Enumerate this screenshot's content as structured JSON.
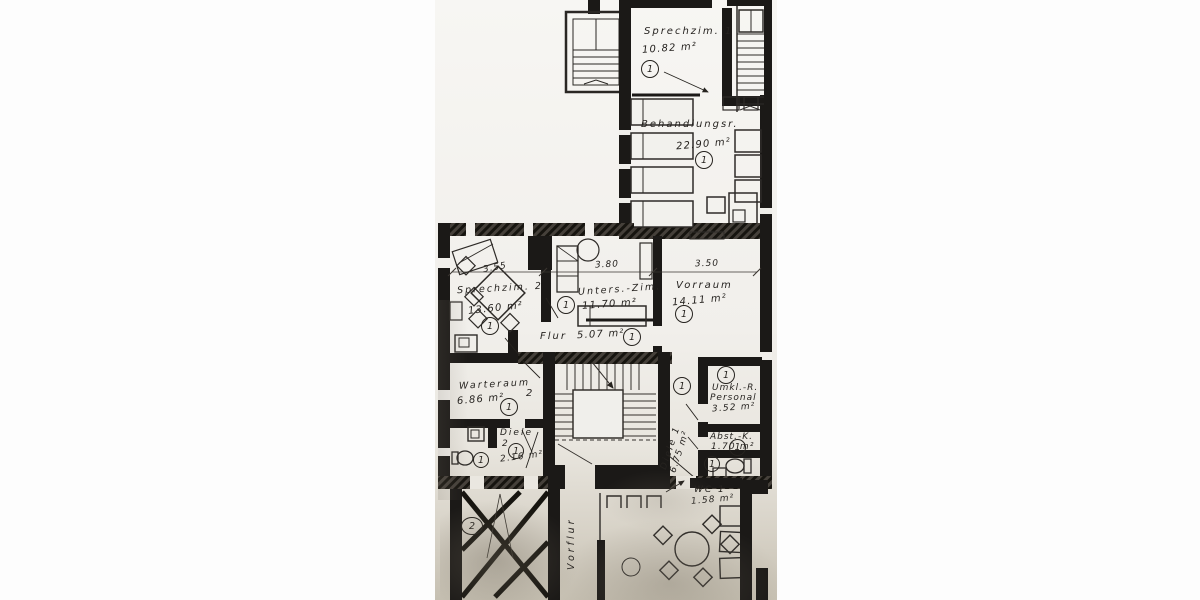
{
  "plan": {
    "rooms": {
      "sprechzim1": {
        "name": "Sprechzim. 1",
        "area": "10.82 m²",
        "mark": "1"
      },
      "behandlungsraum": {
        "name": "Behandlungsr.",
        "area": "22.90 m²",
        "mark": "1"
      },
      "sprechzim2": {
        "name": "Sprechzim. 2",
        "area": "13.60 m²",
        "mark": "1"
      },
      "untersuchungszimmer der": {
        "name": "Unters.-Zim.",
        "area": "11.70 m²",
        "mark": "1"
      },
      "vorraum": {
        "name": "Vorraum",
        "area": "14.11 m²",
        "mark": "1"
      },
      "flur": {
        "name": "Flur",
        "area": "5.07 m²",
        "mark": "1"
      },
      "warteraum": {
        "name": "Warteraum",
        "number": "2",
        "area": "6.86 m²",
        "mark": "1"
      },
      "diele2": {
        "name": "Diele",
        "number": "2",
        "area": "2.16 m²",
        "mark": "1",
        "wc_mark": "1"
      },
      "diele1": {
        "name": "Diele 1",
        "area": "6.75 m²",
        "mark": "1"
      },
      "umkleide_personal": {
        "name": "Umkl.-R.",
        "name2": "Personal",
        "area": "3.52 m²",
        "mark": "1"
      },
      "abstellkammer": {
        "name": "Abst.-K.",
        "area": "1.70 m²",
        "mark": "1"
      },
      "wc_rechts": {
        "mark": "1"
      },
      "wc1": {
        "name": "WC 1",
        "area": "1.58 m²"
      },
      "vorflur": {
        "name": "Vorflur"
      },
      "gekreuzter_raum": {
        "mark": "2"
      }
    },
    "dimensions": {
      "sprechzim2_breite": "3.55",
      "unterszim_breite": "3.80",
      "vorraum_breite": "3.50"
    }
  }
}
